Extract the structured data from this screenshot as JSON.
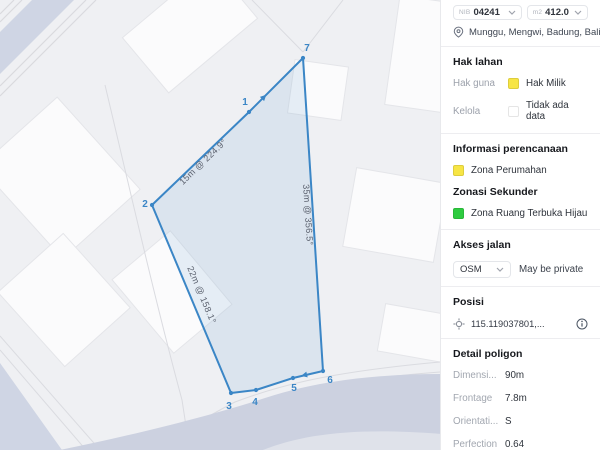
{
  "header": {
    "id_label": "NIB",
    "id_value": "04241",
    "area_label": "m2",
    "area_value": "412.0",
    "location": "Munggu, Mengwi, Badung, Bali"
  },
  "hak_lahan": {
    "title": "Hak lahan",
    "rows": [
      {
        "label": "Hak guna",
        "value": "Hak Milik",
        "swatch": "#f7e544"
      },
      {
        "label": "Kelola",
        "value": "Tidak ada data",
        "swatch": "#ffffff"
      }
    ]
  },
  "perencanaan": {
    "title": "Informasi perencanaan",
    "zone": "Zona Perumahan",
    "zone_swatch": "#f7e544",
    "secondary_title": "Zonasi Sekunder",
    "secondary_zone": "Zona Ruang Terbuka Hijau",
    "secondary_swatch": "#2ecc40"
  },
  "akses_jalan": {
    "title": "Akses jalan",
    "source": "OSM",
    "note": "May be private"
  },
  "posisi": {
    "title": "Posisi",
    "coordinate": "115.119037801,..."
  },
  "detail_poligon": {
    "title": "Detail poligon",
    "rows": [
      {
        "label": "Dimensi...",
        "value": "90m"
      },
      {
        "label": "Frontage",
        "value": "7.8m"
      },
      {
        "label": "Orientati...",
        "value": "S"
      },
      {
        "label": "Perfection",
        "value": "0.64"
      }
    ]
  },
  "map": {
    "stroke": "#3b86c6",
    "fill": "rgba(121,170,214,0.16)",
    "vertices": [
      {
        "n": "7",
        "x": 303,
        "y": 58,
        "lx": 307,
        "ly": 51
      },
      {
        "n": "1",
        "x": 249,
        "y": 112,
        "lx": 245,
        "ly": 105
      },
      {
        "n": "2",
        "x": 152,
        "y": 205,
        "lx": 145,
        "ly": 207
      },
      {
        "n": "3",
        "x": 231,
        "y": 393,
        "lx": 229,
        "ly": 409
      },
      {
        "n": "4",
        "x": 256,
        "y": 390,
        "lx": 255,
        "ly": 405
      },
      {
        "n": "5",
        "x": 293,
        "y": 378,
        "lx": 294,
        "ly": 391
      },
      {
        "n": "6",
        "x": 323,
        "y": 371,
        "lx": 330,
        "ly": 383
      }
    ],
    "edge_labels": [
      {
        "text": "15m @ 224.9°",
        "x": 205,
        "y": 164,
        "rot": -43.8
      },
      {
        "text": "35m @ 356.5°",
        "x": 305,
        "y": 215,
        "rot": 86.3
      },
      {
        "text": "22m @ 158.1°",
        "x": 199,
        "y": 296,
        "rot": 67.2
      }
    ]
  }
}
